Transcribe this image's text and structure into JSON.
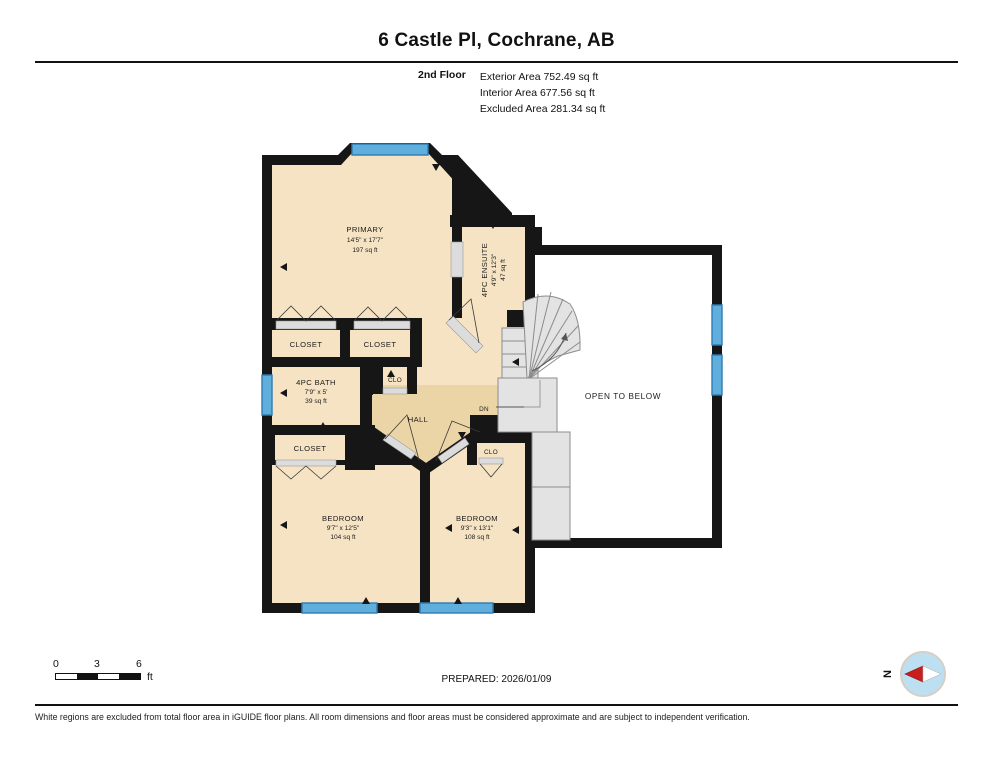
{
  "header": {
    "title": "6 Castle Pl, Cochrane, AB",
    "floor_label": "2nd Floor",
    "areas": [
      "Exterior Area 752.49 sq ft",
      "Interior Area 677.56 sq ft",
      "Excluded Area 281.34 sq ft"
    ]
  },
  "plan": {
    "rooms": [
      {
        "id": "primary",
        "name": "PRIMARY",
        "dims": "14'5\" x 17'7\"",
        "area": "197 sq ft"
      },
      {
        "id": "ensuite",
        "name": "4PC ENSUITE",
        "dims": "4'9\" x 12'3\"",
        "area": "47 sq ft"
      },
      {
        "id": "bath",
        "name": "4PC BATH",
        "dims": "7'9\" x 5'",
        "area": "39 sq ft"
      },
      {
        "id": "bedroom1",
        "name": "BEDROOM",
        "dims": "9'7\" x 12'5\"",
        "area": "104 sq ft"
      },
      {
        "id": "bedroom2",
        "name": "BEDROOM",
        "dims": "9'3\" x 13'1\"",
        "area": "108 sq ft"
      }
    ],
    "hall_label": "HALL",
    "open_below_label": "OPEN TO BELOW",
    "closet_label": "CLOSET",
    "clo_label": "CLO",
    "stairs_down_label": "DN",
    "compass_label": "N"
  },
  "footer": {
    "scale": {
      "ticks": [
        "0",
        "3",
        "6"
      ],
      "unit": "ft"
    },
    "prepared": "PREPARED: 2026/01/09",
    "disclaimer": "White regions are excluded from total floor area in iGUIDE floor plans. All room dimensions and floor areas must be considered approximate and are subject to independent verification."
  },
  "colors": {
    "wall": "#161616",
    "room": "#F6E3C4",
    "hall": "#EBD5A6",
    "window": "#5FAEDC",
    "window_border": "#2F7CB5",
    "stairs": "#E3E3E3",
    "stairs_border": "#8C8C8C",
    "threshold": "#DCDCDC",
    "compass_red": "#C81E1E",
    "compass_blue": "#BCDFF2"
  }
}
